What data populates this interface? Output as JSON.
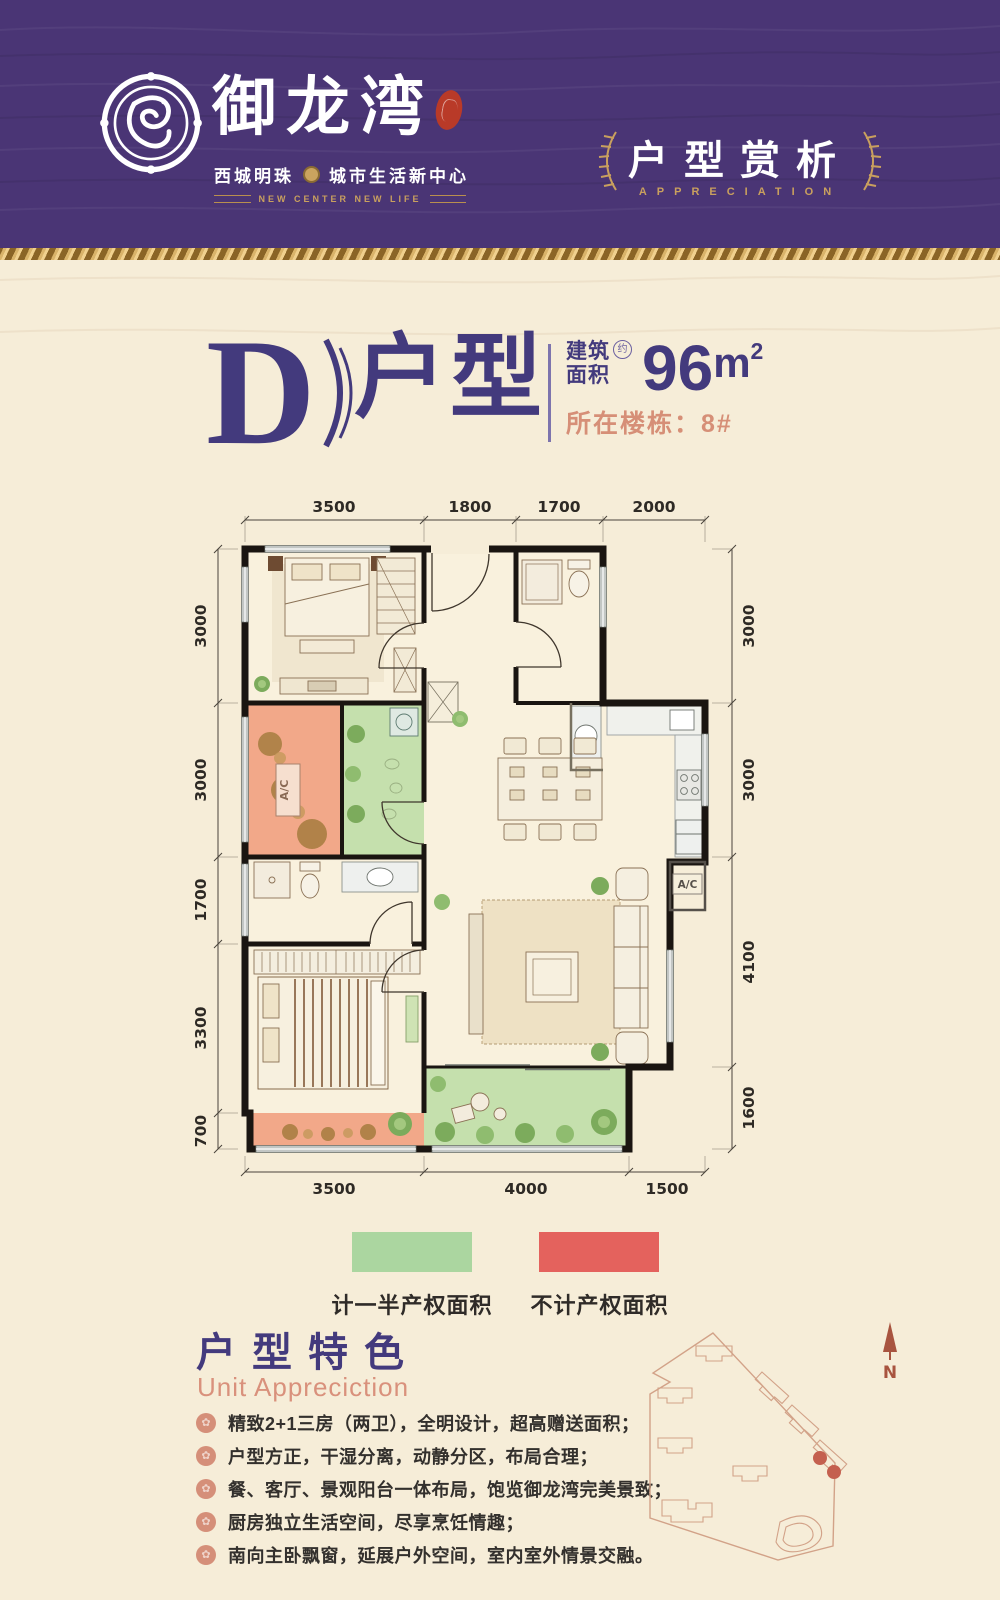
{
  "header": {
    "logo_name": "御龙湾",
    "tagline_left": "西城明珠",
    "tagline_right": "城市生活新中心",
    "tagline_en": "NEW CENTER  NEW LIFE",
    "section_title": "户型赏析",
    "section_subtitle": "APPRECIATION"
  },
  "unit": {
    "letter": "D",
    "suffix": "户型",
    "area_label_1": "建筑",
    "area_label_2": "面积",
    "area_approx": "约",
    "area_value": "96",
    "area_unit": "m",
    "area_sup": "2",
    "building": "所在楼栋：8#"
  },
  "floorplan": {
    "dims_top": [
      "3500",
      "1800",
      "1700",
      "2000"
    ],
    "dims_bottom": [
      "3500",
      "4000",
      "1500"
    ],
    "dims_left": [
      "3000",
      "3000",
      "1700",
      "3300",
      "700"
    ],
    "dims_right": [
      "3000",
      "3000",
      "4100",
      "1600"
    ],
    "ac_label_1": "A/C",
    "ac_label_2": "A/C"
  },
  "legend": {
    "half_label": "计一半产权面积",
    "half_color": "#abd6a0",
    "none_label": "不计产权面积",
    "none_color": "#e4625d"
  },
  "features": {
    "title": "户型特色",
    "subtitle": "Unit Appreciction",
    "items": [
      "精致2+1三房（两卫），全明设计，超高赠送面积；",
      "户型方正，干湿分离，动静分区，布局合理；",
      "餐、客厅、景观阳台一体布局，饱览御龙湾完美景致；",
      "厨房独立生活空间，尽享烹饪情趣；",
      "南向主卧飘窗，延展户外空间，室内室外情景交融。"
    ]
  },
  "siteplan": {
    "north": "N"
  }
}
